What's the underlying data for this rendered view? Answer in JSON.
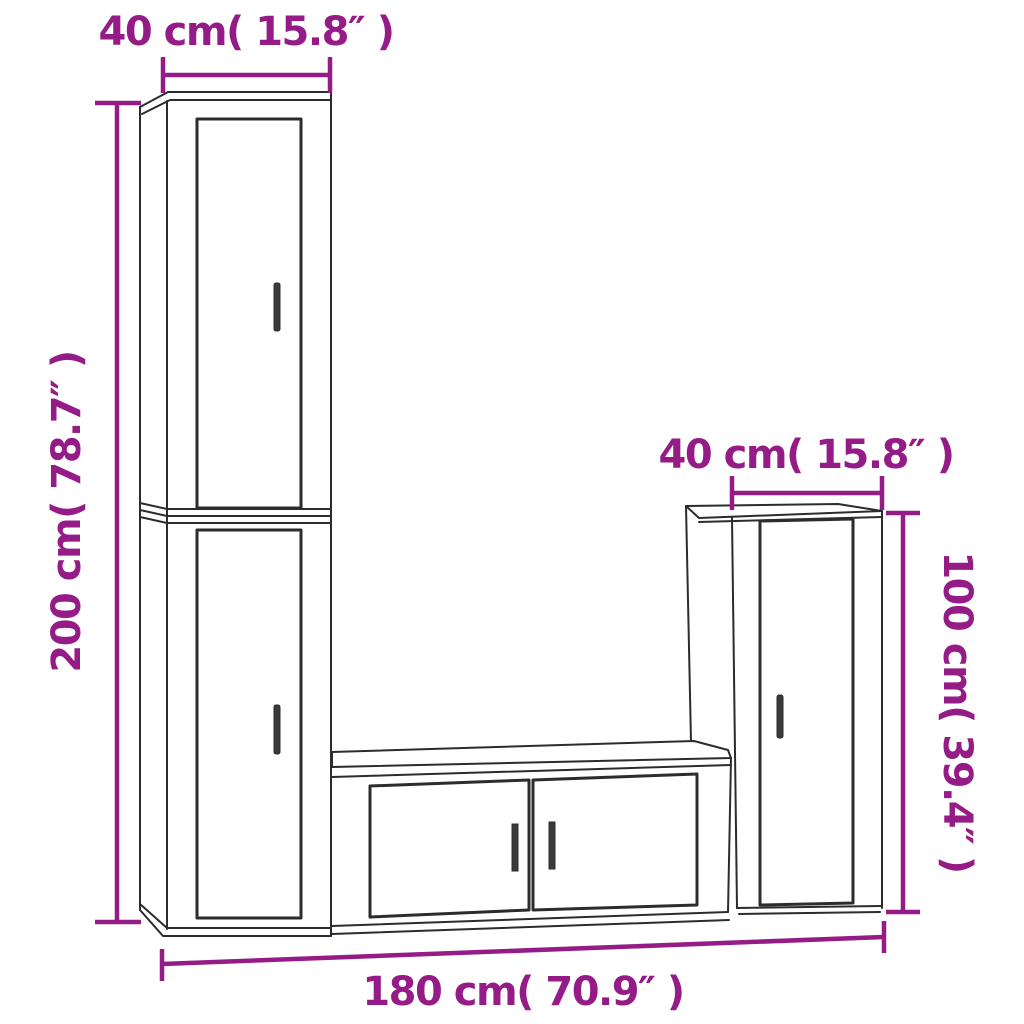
{
  "diagram": {
    "background": "#ffffff",
    "dimension_color": "#951c87",
    "outline_color": "#2c2c2c",
    "handle_color": "#3a3a3a",
    "labels": {
      "top_width": "40 cm( 15.8″ )",
      "left_height": "200 cm( 78.7″ )",
      "right_width": "40 cm( 15.8″ )",
      "right_height": "100 cm( 39.4″ )",
      "bottom_width": "180 cm( 70.9″ )"
    }
  }
}
